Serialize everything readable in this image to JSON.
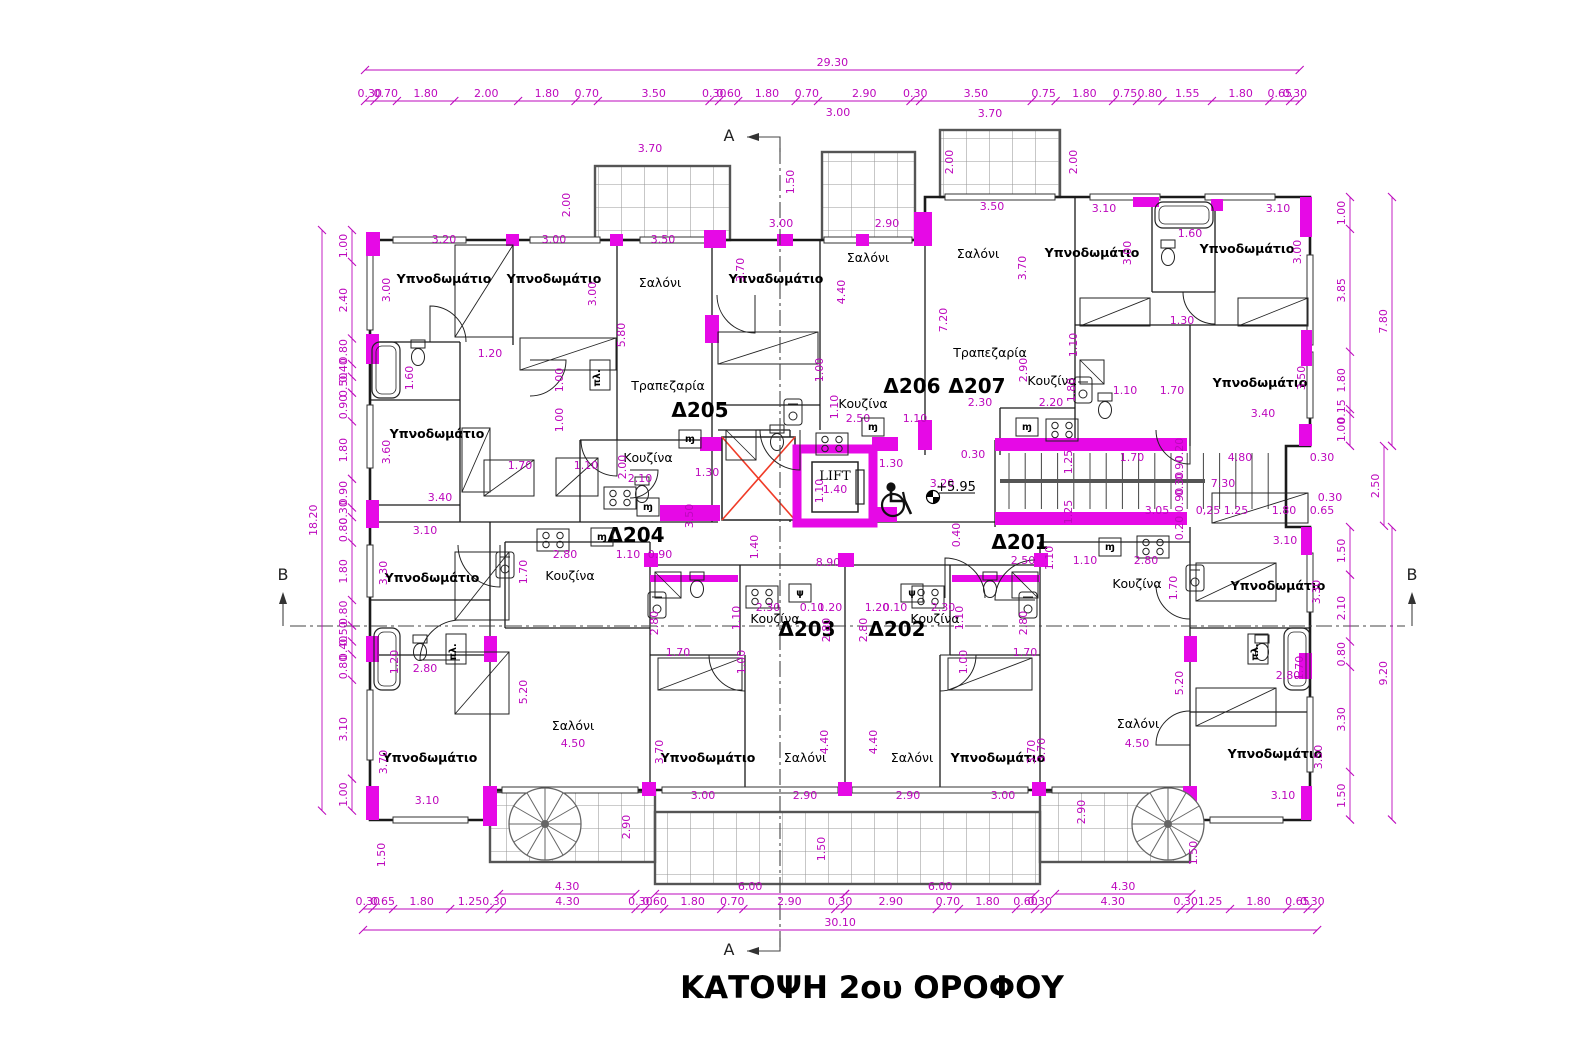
{
  "title": "ΚΑΤΟΨΗ 2ου ΟΡΟΦΟΥ",
  "drawing_type": "architectural floor plan",
  "colors": {
    "dimension": "#bd08bd",
    "column_fill": "#e609e6",
    "wall": "#1a1a1a",
    "light_well_x": "#f03c28",
    "tile_grid": "#999999"
  },
  "lift": {
    "label": "LIFT",
    "dim": "1.40",
    "x": 835,
    "y": 480
  },
  "level_marker": {
    "t": "+5.95",
    "x": 956,
    "y": 497
  },
  "labels": {
    "units": [
      [
        "Δ205",
        700,
        417
      ],
      [
        "Δ206",
        912,
        393
      ],
      [
        "Δ207",
        977,
        393
      ],
      [
        "Δ204",
        636,
        542
      ],
      [
        "Δ201",
        1020,
        549
      ],
      [
        "Δ203",
        807,
        636
      ],
      [
        "Δ202",
        897,
        636
      ]
    ],
    "rooms": [
      [
        "Υπνοδωμάτιο",
        444,
        283,
        1
      ],
      [
        "Υπνοδωμάτιο",
        554,
        283,
        1
      ],
      [
        "Σαλόνι",
        660,
        287,
        0
      ],
      [
        "Υπναδωμάτιο",
        776,
        283,
        1
      ],
      [
        "Σαλόνι",
        868,
        262,
        0
      ],
      [
        "Σαλόνι",
        978,
        258,
        0
      ],
      [
        "Υπνοδωμάτιο",
        1092,
        257,
        1
      ],
      [
        "Υπνοδωμάτιο",
        1247,
        253,
        1
      ],
      [
        "Τραπεζαρία",
        668,
        390,
        0
      ],
      [
        "Τραπεζαρία",
        990,
        357,
        0
      ],
      [
        "Κουζίνα",
        1052,
        385,
        0
      ],
      [
        "Υπνοδωμάτιο",
        1260,
        387,
        1
      ],
      [
        "Υπνοδωμάτιο",
        437,
        438,
        1
      ],
      [
        "Κουζίνα",
        648,
        462,
        0
      ],
      [
        "Κουζίνα",
        863,
        408,
        0
      ],
      [
        "Υπνοδωμάτιο",
        432,
        582,
        1
      ],
      [
        "Κουζίνα",
        570,
        580,
        0
      ],
      [
        "Κουζίνα",
        1137,
        588,
        0
      ],
      [
        "Υπνοδωμάτιο",
        1278,
        590,
        1
      ],
      [
        "Κουζίνα",
        775,
        623,
        0
      ],
      [
        "Κουζίνα",
        935,
        623,
        0
      ],
      [
        "Σαλόνι",
        573,
        730,
        0
      ],
      [
        "Υπνοδωμάτιο",
        430,
        762,
        1
      ],
      [
        "Υπνοδωμάτιο",
        708,
        762,
        1
      ],
      [
        "Σαλόνι",
        805,
        762,
        0
      ],
      [
        "Σαλόνι",
        912,
        762,
        0
      ],
      [
        "Υπνοδωμάτιο",
        998,
        762,
        1
      ],
      [
        "Σαλόνι",
        1138,
        728,
        0
      ],
      [
        "Υπνοδωμάτιο",
        1275,
        758,
        1
      ]
    ],
    "glyphs": [
      [
        "πλ.",
        600,
        378,
        1
      ],
      [
        "πλ.",
        456,
        652,
        1
      ],
      [
        "πλ.",
        1258,
        652,
        1
      ],
      [
        "ψ",
        800,
        596,
        0
      ],
      [
        "ψ",
        912,
        596,
        0
      ],
      [
        "ɱ",
        690,
        442,
        0
      ],
      [
        "ɱ",
        873,
        430,
        0
      ],
      [
        "ɱ",
        1027,
        430,
        0
      ],
      [
        "ɱ",
        602,
        540,
        0
      ],
      [
        "ɱ",
        1110,
        550,
        0
      ],
      [
        "ɱ",
        648,
        510,
        0
      ]
    ],
    "markers": [
      [
        "A",
        729,
        141
      ],
      [
        "A",
        729,
        955
      ],
      [
        "B",
        283,
        580
      ],
      [
        "B",
        1412,
        580
      ]
    ],
    "dims_h": [
      [
        "3.00",
        838,
        116
      ],
      [
        "3.70",
        990,
        117
      ],
      [
        "3.70",
        650,
        152
      ],
      [
        "3.20",
        444,
        243
      ],
      [
        "3.00",
        554,
        243
      ],
      [
        "3.50",
        663,
        243
      ],
      [
        "3.00",
        781,
        227
      ],
      [
        "2.90",
        887,
        227
      ],
      [
        "3.50",
        992,
        210
      ],
      [
        "3.10",
        1104,
        212
      ],
      [
        "3.10",
        1278,
        212
      ],
      [
        "1.60",
        1190,
        237
      ],
      [
        "1.20",
        490,
        357
      ],
      [
        "1.30",
        1182,
        324
      ],
      [
        "1.10",
        1125,
        394
      ],
      [
        "1.70",
        1172,
        394
      ],
      [
        "3.40",
        1263,
        417
      ],
      [
        "2.50",
        858,
        422
      ],
      [
        "1.10",
        915,
        422
      ],
      [
        "2.30",
        980,
        406
      ],
      [
        "2.20",
        1051,
        406
      ],
      [
        "1.70",
        520,
        469
      ],
      [
        "1.10",
        586,
        469
      ],
      [
        "2.10",
        640,
        482
      ],
      [
        "3.40",
        440,
        501
      ],
      [
        "1.30",
        707,
        476
      ],
      [
        "1.30",
        891,
        467
      ],
      [
        "0.30",
        973,
        458
      ],
      [
        "3.20",
        942,
        487
      ],
      [
        "8.90",
        828,
        566
      ],
      [
        "1.70",
        1132,
        461
      ],
      [
        "4.80",
        1240,
        461
      ],
      [
        "0.30",
        1322,
        461
      ],
      [
        "7.30",
        1223,
        487
      ],
      [
        "0.30",
        1330,
        501
      ],
      [
        "3.05",
        1157,
        514
      ],
      [
        "0,25",
        1208,
        514
      ],
      [
        "1.25",
        1236,
        514
      ],
      [
        "1.80",
        1284,
        514
      ],
      [
        "0.65",
        1322,
        514
      ],
      [
        "2.50",
        1023,
        564
      ],
      [
        "1.10",
        1085,
        564
      ],
      [
        "2.80",
        1146,
        564
      ],
      [
        "2.80",
        565,
        558
      ],
      [
        "1.10",
        628,
        558
      ],
      [
        "0.90",
        660,
        558
      ],
      [
        "3.10",
        425,
        534
      ],
      [
        "3.10",
        1285,
        544
      ],
      [
        "2.30",
        768,
        611
      ],
      [
        "0.10",
        812,
        611
      ],
      [
        "1.20",
        830,
        611
      ],
      [
        "1.20",
        877,
        611
      ],
      [
        "0.10",
        895,
        611
      ],
      [
        "2.30",
        943,
        611
      ],
      [
        "1.70",
        678,
        656
      ],
      [
        "1.70",
        1025,
        656
      ],
      [
        "2.80",
        425,
        672
      ],
      [
        "2.80",
        1288,
        679
      ],
      [
        "4.50",
        573,
        747
      ],
      [
        "4.50",
        1137,
        747
      ],
      [
        "3.00",
        703,
        799
      ],
      [
        "2.90",
        805,
        799
      ],
      [
        "2.90",
        908,
        799
      ],
      [
        "3.00",
        1003,
        799
      ],
      [
        "3.10",
        427,
        804
      ],
      [
        "3.10",
        1283,
        799
      ]
    ],
    "dims_v": [
      [
        "2.00",
        570,
        205
      ],
      [
        "1.50",
        794,
        182
      ],
      [
        "2.00",
        953,
        162
      ],
      [
        "2.00",
        1077,
        162
      ],
      [
        "3.00",
        390,
        290
      ],
      [
        "3.00",
        596,
        294
      ],
      [
        "5.80",
        625,
        335
      ],
      [
        "3.70",
        744,
        270
      ],
      [
        "4.40",
        845,
        292
      ],
      [
        "7.20",
        947,
        320
      ],
      [
        "3.70",
        1026,
        268
      ],
      [
        "3.00",
        1131,
        253
      ],
      [
        "3.00",
        1301,
        252
      ],
      [
        "1.60",
        413,
        378
      ],
      [
        "1.00",
        563,
        380
      ],
      [
        "1.00",
        563,
        420
      ],
      [
        "1.00",
        823,
        370
      ],
      [
        "1.10",
        838,
        407
      ],
      [
        "2.90",
        1027,
        370
      ],
      [
        "1.80",
        1075,
        390
      ],
      [
        "1.10",
        1077,
        345
      ],
      [
        "3.50",
        1305,
        378
      ],
      [
        "3.60",
        390,
        452
      ],
      [
        "2.00",
        626,
        467
      ],
      [
        "3.50",
        693,
        516
      ],
      [
        "1.40",
        758,
        547
      ],
      [
        "1.10",
        823,
        491
      ],
      [
        "1.25",
        1072,
        462
      ],
      [
        "1.25",
        1072,
        512
      ],
      [
        "0.40",
        960,
        535
      ],
      [
        "0.20",
        1183,
        450
      ],
      [
        "0.90",
        1183,
        468
      ],
      [
        "0.30",
        1183,
        484
      ],
      [
        "0.90",
        1183,
        500
      ],
      [
        "0.20",
        1183,
        528
      ],
      [
        "1.10",
        1053,
        558
      ],
      [
        "1.70",
        527,
        572
      ],
      [
        "3.30",
        387,
        573
      ],
      [
        "3.30",
        1320,
        592
      ],
      [
        "1.70",
        1177,
        588
      ],
      [
        "1.10",
        740,
        618
      ],
      [
        "1.10",
        963,
        618
      ],
      [
        "2.80",
        658,
        623
      ],
      [
        "2.80",
        830,
        630
      ],
      [
        "2.80",
        867,
        630
      ],
      [
        "2.80",
        1027,
        623
      ],
      [
        "1.00",
        745,
        662
      ],
      [
        "1.00",
        967,
        662
      ],
      [
        "1.20",
        398,
        662
      ],
      [
        "1.70",
        1303,
        668
      ],
      [
        "5.20",
        527,
        692
      ],
      [
        "5.20",
        1183,
        683
      ],
      [
        "3.70",
        663,
        752
      ],
      [
        "3.70",
        1035,
        752
      ],
      [
        "4.40",
        828,
        742
      ],
      [
        "4.40",
        877,
        742
      ],
      [
        "3.70",
        387,
        762
      ],
      [
        "3.70",
        1045,
        750
      ],
      [
        "3.50",
        1322,
        757
      ],
      [
        "2.90",
        630,
        827
      ],
      [
        "2.90",
        1085,
        812
      ],
      [
        "1.50",
        825,
        849
      ],
      [
        "1.50",
        385,
        855
      ],
      [
        "1.50",
        1197,
        853
      ]
    ]
  },
  "dim_chains": [
    {
      "o": "h",
      "x": 365,
      "y": 70,
      "s": 31.9,
      "v": [
        "29.30"
      ]
    },
    {
      "o": "h",
      "x": 365,
      "y": 101,
      "s": 31.9,
      "v": [
        "0.30",
        "0.70",
        "1.80",
        "2.00",
        "1.80",
        "0.70",
        "3.50",
        "0.30",
        "0.60",
        "1.80",
        "0.70",
        "2.90",
        "0.30",
        "3.50",
        "0.75",
        "1.80",
        "0.75",
        "0.80",
        "1.55",
        "1.80",
        "0.65",
        "0.30"
      ]
    },
    {
      "o": "h",
      "x": 499,
      "y": 894,
      "s": 31.7,
      "v": [
        "4.30"
      ]
    },
    {
      "o": "h",
      "x": 655,
      "y": 894,
      "s": 31.7,
      "v": [
        "6.00"
      ]
    },
    {
      "o": "h",
      "x": 845,
      "y": 894,
      "s": 31.7,
      "v": [
        "6.00"
      ]
    },
    {
      "o": "h",
      "x": 1055,
      "y": 894,
      "s": 31.7,
      "v": [
        "4.30"
      ]
    },
    {
      "o": "h",
      "x": 363,
      "y": 909,
      "s": 31.7,
      "v": [
        "0.30",
        "0.65",
        "1.80",
        "1.25",
        "0.30",
        "4.30",
        "0.30",
        "0.60",
        "1.80",
        "0.70",
        "2.90",
        "0.30",
        "2.90",
        "0.70",
        "1.80",
        "0.60",
        "0.30",
        "4.30",
        "0.30",
        "1.25",
        "1.80",
        "0.65",
        "0.30"
      ]
    },
    {
      "o": "h",
      "x": 363,
      "y": 930,
      "s": 31.7,
      "v": [
        "30.10"
      ]
    },
    {
      "o": "v",
      "x": 352,
      "y": 230,
      "s": 31.9,
      "v": [
        "1.00",
        "2.40",
        "0.80",
        "0.40",
        "0.50",
        "0.90",
        "1.80",
        "0.90",
        "0.30",
        "0.80",
        "1.80",
        "0.80",
        "0.50",
        "0.40",
        "0.80",
        "3.10",
        "1.00"
      ]
    },
    {
      "o": "v",
      "x": 322,
      "y": 230,
      "s": 31.9,
      "v": [
        "18.20"
      ]
    },
    {
      "o": "v",
      "x": 1350,
      "y": 197,
      "s": 31.9,
      "v": [
        "1.00",
        "3.85",
        "1.80",
        "0.15",
        "1.00"
      ]
    },
    {
      "o": "v",
      "x": 1392,
      "y": 197,
      "s": 31.9,
      "v": [
        "7.80"
      ]
    },
    {
      "o": "v",
      "x": 1384,
      "y": 446,
      "s": 31.9,
      "v": [
        "2.50"
      ]
    },
    {
      "o": "v",
      "x": 1350,
      "y": 527,
      "s": 31.8,
      "v": [
        "1.50",
        "2.10",
        "0.80",
        "3.30",
        "1.50"
      ]
    },
    {
      "o": "v",
      "x": 1392,
      "y": 527,
      "s": 31.8,
      "v": [
        "9.20"
      ]
    }
  ]
}
